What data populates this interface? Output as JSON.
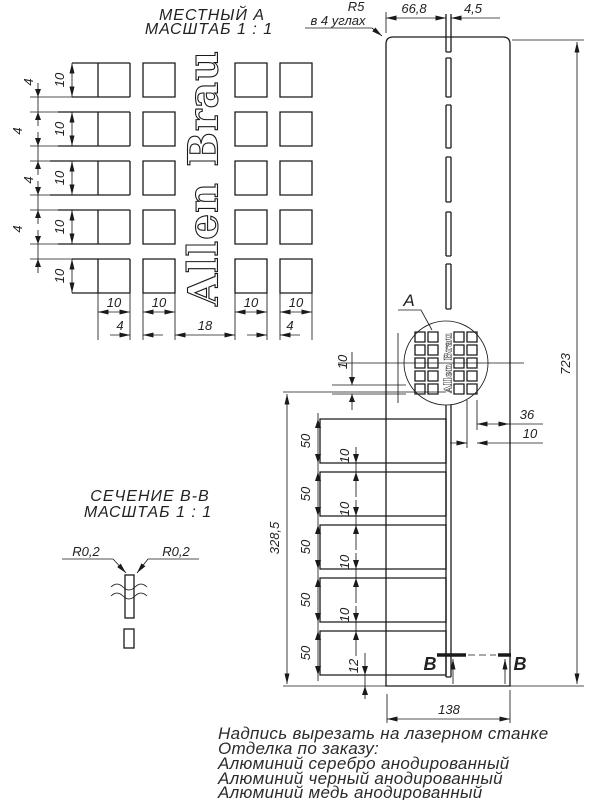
{
  "local_view": {
    "title1": "МЕСТНЫЙ А",
    "title2": "МАСШТАБ 1 : 1",
    "row_heights": [
      "10",
      "10",
      "10",
      "10",
      "10"
    ],
    "row_gaps": [
      "4",
      "4",
      "4",
      "4"
    ],
    "col_widths": [
      "10",
      "10",
      "10",
      "10"
    ],
    "col_gaps": [
      "4",
      "18",
      "4"
    ]
  },
  "brand": "Allen Brau",
  "panel": {
    "corner_radius_note1": "R5",
    "corner_radius_note2": "в 4 углах",
    "dim_top_offset": "66,8",
    "dim_slot_width": "4,5",
    "dim_total_height": "723",
    "detail_mark": "A",
    "dim_hole_pitch": "10",
    "dim_right_edge": "36",
    "dim_right_inner": "10",
    "slot_lengths": [
      "50",
      "50",
      "50",
      "50",
      "50"
    ],
    "slot_gaps": [
      "10",
      "10",
      "10",
      "10"
    ],
    "dim_bottom_edge": "12",
    "dim_slot_zone": "328,5",
    "dim_width": "138",
    "section_mark_left": "В",
    "section_mark_right": "В"
  },
  "section_view": {
    "title1": "СЕЧЕНИЕ В-В",
    "title2": "МАСШТАБ 1 : 1",
    "radius_left": "R0,2",
    "radius_right": "R0,2"
  },
  "notes": [
    "Надпись вырезать на лазерном станке",
    "Отделка по заказу:",
    "Алюминий серебро анодированный",
    "Алюминий черный анодированный",
    "Алюминий медь анодированный"
  ]
}
